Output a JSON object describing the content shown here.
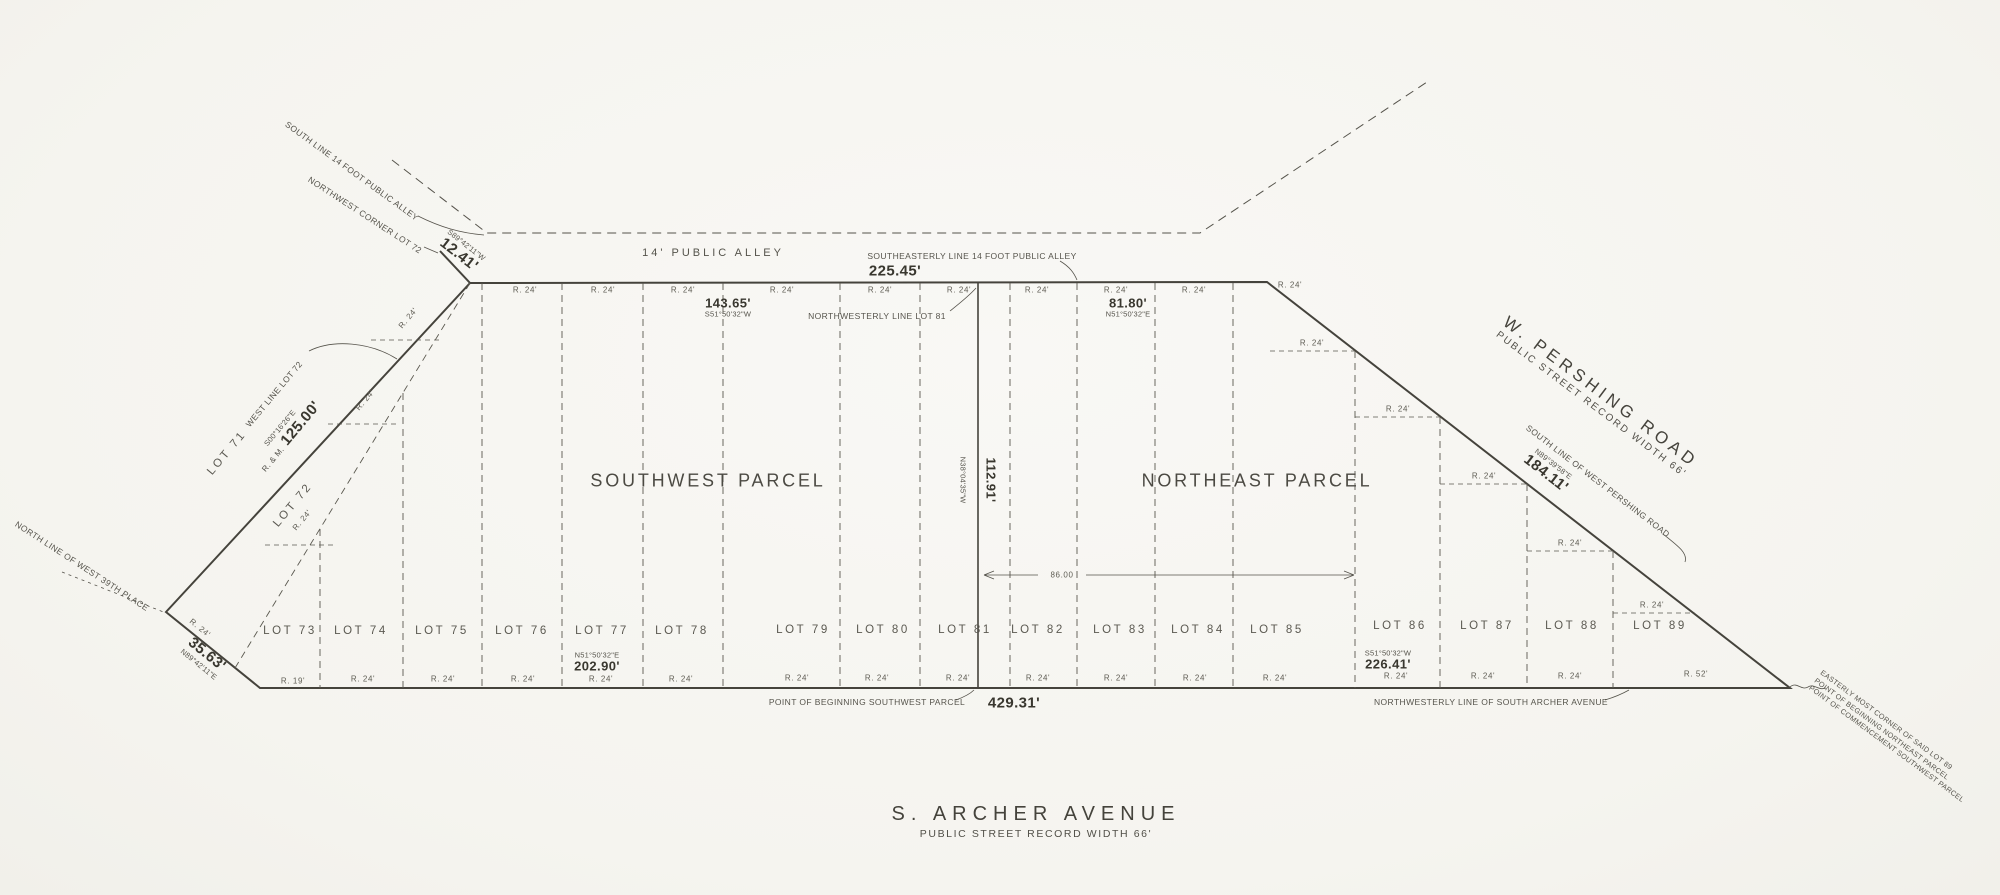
{
  "drawing": {
    "alley_label": "14' PUBLIC ALLEY",
    "parcels": {
      "southwest": "SOUTHWEST PARCEL",
      "northeast": "NORTHEAST PARCEL"
    },
    "streets": {
      "pershing": {
        "name": "W. PERSHING ROAD",
        "subtitle": "PUBLIC STREET RECORD WIDTH 66'"
      },
      "archer": {
        "name": "S. ARCHER AVENUE",
        "subtitle": "PUBLIC STREET RECORD WIDTH 66'"
      }
    },
    "side_lots": [
      {
        "label": "LOT 71"
      },
      {
        "label": "LOT 72"
      }
    ],
    "lots": [
      {
        "label": "LOT 73"
      },
      {
        "label": "LOT 74"
      },
      {
        "label": "LOT 75"
      },
      {
        "label": "LOT 76"
      },
      {
        "label": "LOT 77"
      },
      {
        "label": "LOT 78"
      },
      {
        "label": "LOT 79"
      },
      {
        "label": "LOT 80"
      },
      {
        "label": "LOT 81"
      },
      {
        "label": "LOT 82"
      },
      {
        "label": "LOT 83"
      },
      {
        "label": "LOT 84"
      },
      {
        "label": "LOT 85"
      },
      {
        "label": "LOT 86"
      },
      {
        "label": "LOT 87"
      },
      {
        "label": "LOT 88"
      },
      {
        "label": "LOT 89"
      }
    ],
    "dims": {
      "alley_bearing_nw": {
        "bearing": "S89°42'11\"W",
        "value": "12.41'"
      },
      "alley_se": {
        "value": "225.45'"
      },
      "top_sw": {
        "value": "143.65'",
        "bearing": "S51°50'32\"W"
      },
      "top_ne": {
        "value": "81.80'",
        "bearing": "N51°50'32\"E"
      },
      "west": {
        "bearing": "S00°16'26\"E",
        "prefix": "R. & M.",
        "value": "125.00'"
      },
      "sw_corner": {
        "value": "35.63'",
        "bearing": "N89°42'11\"E"
      },
      "bottom_sw": {
        "bearing": "N51°50'32\"E",
        "value": "202.90'"
      },
      "bottom_total": {
        "value": "429.31'"
      },
      "bottom_ne": {
        "bearing": "S51°50'32\"W",
        "value": "226.41'"
      },
      "divider": {
        "value": "112.91'",
        "bearing": "N38°04'35\"W"
      },
      "pershing": {
        "bearing": "N89°39'58\"E",
        "value": "184.11'"
      },
      "inner": {
        "value": "86.00"
      }
    },
    "notes": {
      "south_line_alley": "SOUTH LINE 14 FOOT PUBLIC ALLEY",
      "nw_corner_lot72": "NORTHWEST CORNER LOT 72",
      "se_line_alley": "SOUTHEASTERLY LINE 14 FOOT PUBLIC ALLEY",
      "nw_line_lot81": "NORTHWESTERLY LINE LOT 81",
      "west_line_lot72": "WEST LINE LOT 72",
      "north_line_39th": "NORTH LINE OF WEST 39TH PLACE",
      "south_line_pershing": "SOUTH LINE OF WEST PERSHING ROAD",
      "pob_sw": "POINT OF BEGINNING SOUTHWEST PARCEL",
      "nw_line_archer": "NORTHWESTERLY LINE OF SOUTH ARCHER AVENUE"
    },
    "corner_note_lines": [
      "EASTERLY MOST CORNER OF SAID LOT 89",
      "POINT OF BEGINNING NORTHEAST PARCEL",
      "POINT OF COMMENCEMENT SOUTHWEST PARCEL"
    ],
    "ticks": {
      "top": [
        "R. 24'",
        "R. 24'",
        "R. 24'",
        "R. 24'",
        "R. 24'",
        "R. 24'",
        "R. 24'",
        "R. 24'",
        "R. 24'",
        "R. 24'"
      ],
      "bottom": [
        "R. 19'",
        "R. 24'",
        "R. 24'",
        "R. 24'",
        "R. 24'",
        "R. 24'",
        "R. 24'",
        "R. 24'",
        "R. 24'",
        "R. 24'",
        "R. 24'",
        "R. 24'",
        "R. 24'",
        "R. 24'",
        "R. 24'",
        "R. 24'",
        "R. 52'"
      ],
      "right": [
        "R. 24'",
        "R. 24'",
        "R. 24'",
        "R. 24'",
        "R. 24'"
      ],
      "left": [
        "R. 24'",
        "R. 24'",
        "R. 24'",
        "R. 24'"
      ]
    }
  }
}
